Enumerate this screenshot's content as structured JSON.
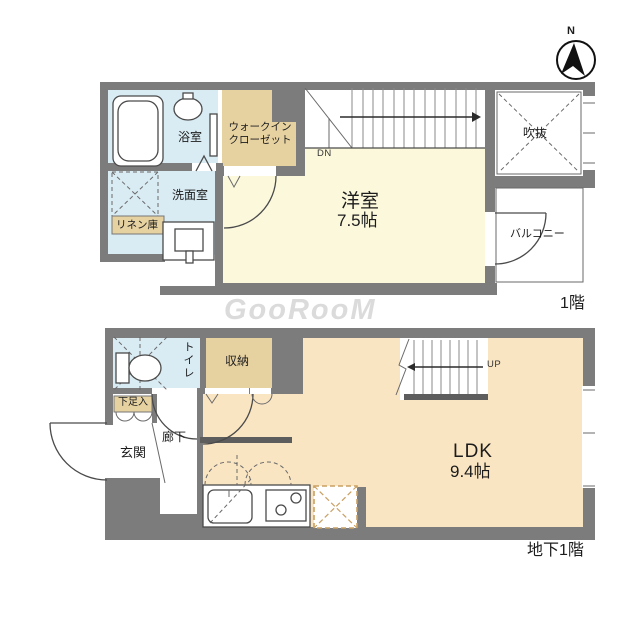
{
  "meta": {
    "compass_label": "N",
    "watermark": "GooRooM"
  },
  "colors": {
    "wall-gray": "#7c7c7c",
    "wet-blue": "#d9ebf3",
    "closet-tan": "#e6d1a1",
    "room-cream": "#fbf8dc",
    "ldk-peach": "#fae5c3",
    "fridge-tan": "#c9a063",
    "line-dark": "#4a4a4a",
    "text-dark": "#1c1c1c"
  },
  "floor1": {
    "name_label": "1階",
    "rooms": {
      "bathroom": "浴室",
      "wic_line1": "ウォークイン",
      "wic_line2": "クローゼット",
      "washroom": "洗面室",
      "linen": "リネン庫",
      "western_room": "洋室",
      "western_room_size": "7.5帖",
      "void_space": "吹抜",
      "balcony": "バルコニー",
      "stairs_down": "DN"
    }
  },
  "basement": {
    "name_label": "地下1階",
    "rooms": {
      "toilet": "トイレ",
      "storage": "収納",
      "shoe_box": "下足入",
      "entrance": "玄関",
      "hallway": "廊下",
      "ldk": "LDK",
      "ldk_size": "9.4帖",
      "stairs_up": "UP"
    }
  }
}
